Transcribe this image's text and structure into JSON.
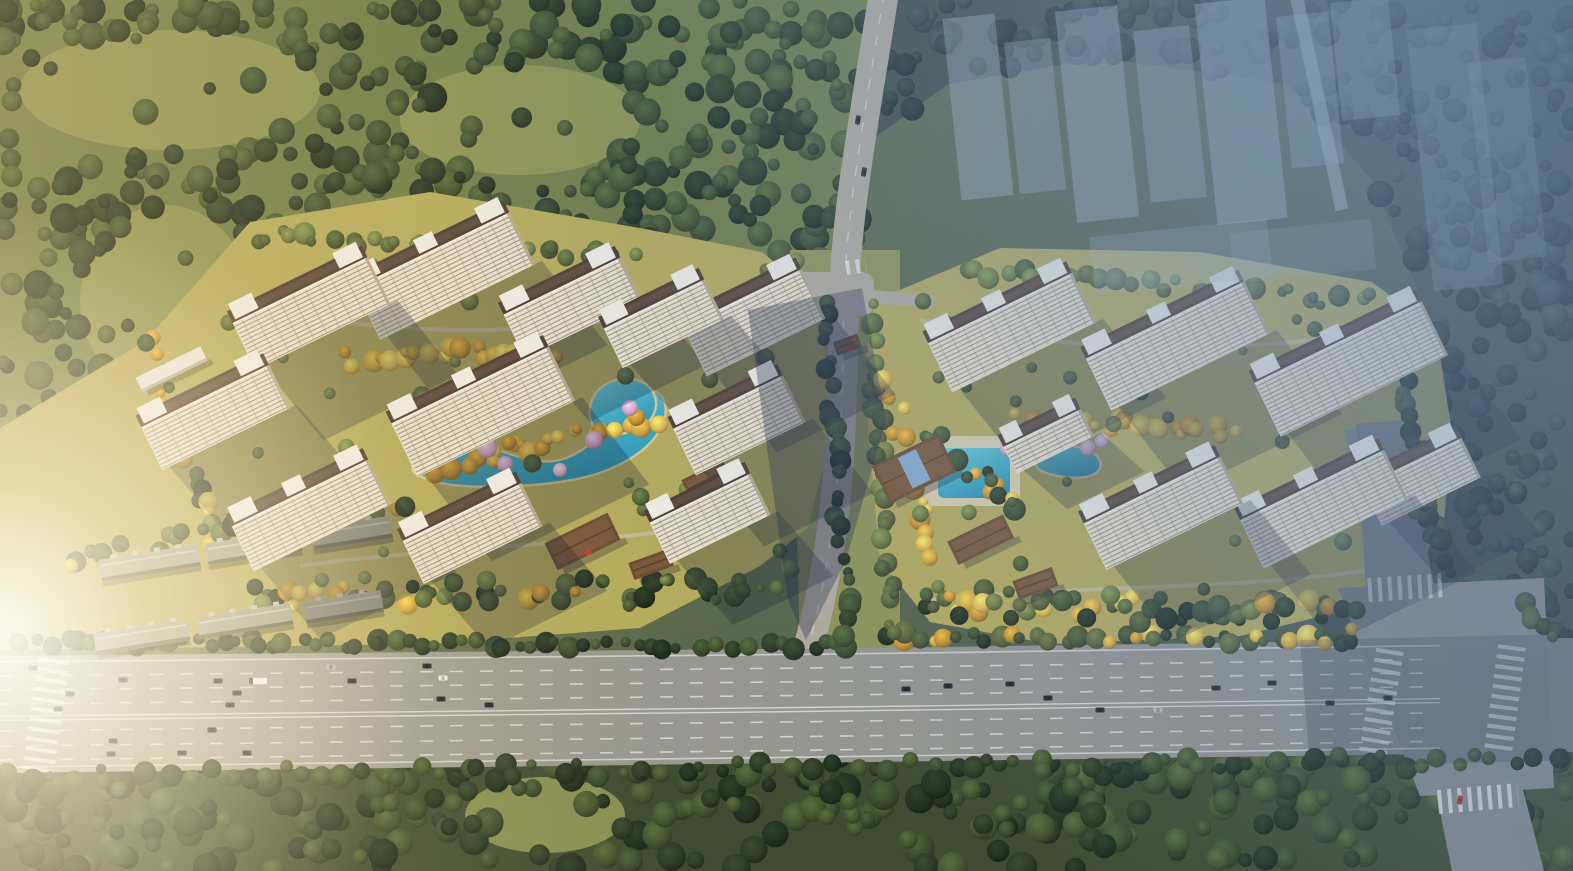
{
  "meta": {
    "type": "aerial-architectural-rendering",
    "width": 1573,
    "height": 871,
    "seed": 7
  },
  "palette": {
    "baseLeft": "#76824c",
    "baseRight": "#47564b",
    "meadow": "#8f9755",
    "forestBaseA": "#6f7d48",
    "forestBaseB": "#3f4c31",
    "forestBaseC": "#3d4a41",
    "darkTrees": [
      "#2c3a25",
      "#3a4a2d",
      "#223020",
      "#43532f"
    ],
    "hazeTrees": [
      "#26332c",
      "#31403a",
      "#1e2a26"
    ],
    "goldTrees": [
      "#d2a33c",
      "#e2b94e",
      "#c08f2f"
    ],
    "siteTrees": [
      "#556237",
      "#6a783f",
      "#485531"
    ],
    "siteLawn": "#b5ab5c",
    "corridorGround": "#8f9457",
    "westLawn": "#b8a95e",
    "water": "#41b8c6",
    "waterLight": "#6fd2da",
    "waterDeep": "#2795b4",
    "waterEdge": "#d8c892",
    "poolDeck": "#d9cfae",
    "blossoms": [
      "#eebbd4",
      "#d9a3c4",
      "#e4afc9"
    ],
    "facade": "#e9e1cd",
    "floorLine": "#57493c",
    "mullion": "#8b7d6a",
    "roof": "#4c3c31",
    "roofInner": "#6b564a",
    "roofBox": "#efece3",
    "endCap": "#b4a88f",
    "towerShadow": "rgba(19,29,46,0.28)",
    "lowRoof": "#a4a38c",
    "lowRidge": "#c6c5b0",
    "lowEdge": "#5f614b",
    "podium": "#e8e6dc",
    "club": "#6b4d33",
    "clubRidge": "#84603f",
    "skylight": "#86add0",
    "redAccent": "#c23b2e",
    "asphalt": "#97978f",
    "asphaltLight": "#b2ab9e",
    "asphaltDark": "#85888b",
    "roadLine": "rgba(255,255,255,0.75)",
    "sidewalk": "#cfc7b3",
    "carDark": "#262b33",
    "carWhite": "#f1f1ee",
    "carSilver": "#b7babc",
    "carRed": "#b03a30",
    "ghost": "#a9bccd",
    "stream": "#5e7487",
    "trail": "#8a9160",
    "bigShadow": "rgba(28,38,66,0.35)",
    "zoneShadow": "rgba(25,35,52,0.22)"
  },
  "scene": {
    "forests": [
      {
        "name": "forest-top-left",
        "base": "forestBaseA",
        "n": 400,
        "rmin": 6,
        "rmax": 15,
        "mix": "dark",
        "poly": [
          [
            0,
            0
          ],
          [
            878,
            0
          ],
          [
            852,
            292
          ],
          [
            742,
            302
          ],
          [
            642,
            252
          ],
          [
            470,
            206
          ],
          [
            300,
            212
          ],
          [
            150,
            340
          ],
          [
            0,
            432
          ]
        ],
        "meadows": [
          {
            "cx": 170,
            "cy": 90,
            "rx": 150,
            "ry": 60
          },
          {
            "cx": 165,
            "cy": 300,
            "rx": 85,
            "ry": 95
          },
          {
            "cx": 520,
            "cy": 120,
            "rx": 120,
            "ry": 55
          }
        ]
      },
      {
        "name": "forest-bottom",
        "base": "forestBaseB",
        "n": 310,
        "rmin": 7,
        "rmax": 16,
        "mix": "dark",
        "poly": [
          [
            0,
            758
          ],
          [
            1573,
            746
          ],
          [
            1573,
            871
          ],
          [
            0,
            871
          ]
        ],
        "meadows": [
          {
            "cx": 545,
            "cy": 815,
            "rx": 80,
            "ry": 38
          }
        ]
      },
      {
        "name": "forest-right-haze",
        "base": "forestBaseC",
        "n": 290,
        "rmin": 6,
        "rmax": 14,
        "mix": "haze",
        "poly": [
          [
            880,
            0
          ],
          [
            1573,
            0
          ],
          [
            1573,
            752
          ],
          [
            1500,
            748
          ],
          [
            1468,
            640
          ],
          [
            1442,
            540
          ],
          [
            1430,
            320
          ],
          [
            1372,
            180
          ],
          [
            1288,
            84
          ],
          [
            1100,
            58
          ],
          [
            948,
            84
          ],
          [
            872,
            140
          ]
        ],
        "meadows": []
      }
    ],
    "westLawnPoly": [
      [
        0,
        428
      ],
      [
        150,
        338
      ],
      [
        280,
        380
      ],
      [
        420,
        470
      ],
      [
        430,
        644
      ],
      [
        0,
        650
      ]
    ],
    "corridorPoly": [
      [
        790,
        250
      ],
      [
        900,
        250
      ],
      [
        900,
        655
      ],
      [
        800,
        655
      ]
    ],
    "sites": [
      {
        "name": "site-left-lawn",
        "poly": [
          [
            150,
            336
          ],
          [
            250,
            222
          ],
          [
            430,
            192
          ],
          [
            640,
            228
          ],
          [
            762,
            252
          ],
          [
            820,
            300
          ],
          [
            832,
            430
          ],
          [
            808,
            528
          ],
          [
            760,
            566
          ],
          [
            640,
            628
          ],
          [
            430,
            644
          ],
          [
            300,
            622
          ],
          [
            210,
            562
          ],
          [
            160,
            452
          ]
        ]
      },
      {
        "name": "site-right-lawn",
        "poly": [
          [
            876,
            300
          ],
          [
            1000,
            248
          ],
          [
            1200,
            252
          ],
          [
            1372,
            282
          ],
          [
            1436,
            330
          ],
          [
            1452,
            432
          ],
          [
            1442,
            544
          ],
          [
            1380,
            602
          ],
          [
            1240,
            636
          ],
          [
            1050,
            644
          ],
          [
            930,
            622
          ],
          [
            880,
            560
          ],
          [
            868,
            430
          ],
          [
            868,
            330
          ]
        ]
      }
    ],
    "walkways": [
      "M258,306 C380,336 540,340 690,306",
      "M300,566 C440,546 600,546 724,522",
      "M920,320 C1060,352 1240,356 1380,330",
      "M930,600 C1060,586 1240,590 1370,570"
    ],
    "stream": {
      "d": "M470,-6 C480,60 492,120 512,180 C530,232 560,280 592,318",
      "w": 13
    },
    "trail": {
      "d": "M-6,128 C140,96 300,62 436,-6",
      "w": 9
    },
    "ponds": [
      {
        "name": "pond-left-main",
        "d": "M414,462 C430,442 466,438 498,450 C524,459 546,466 566,458 C592,448 604,430 616,410 C626,392 642,384 656,392 C670,400 668,420 656,436 C640,458 606,474 572,480 C534,487 466,490 436,482 C418,477 408,472 414,462 Z"
      },
      {
        "name": "pond-left-lagoon",
        "d": "M594,428 C584,410 592,390 610,382 C628,374 648,380 654,394 C660,408 652,424 636,430 C622,435 602,438 594,428 Z"
      },
      {
        "name": "pond-right",
        "d": "M1036,462 C1040,448 1056,442 1074,446 C1092,450 1104,458 1100,468 C1096,478 1076,480 1058,476 C1044,473 1034,470 1036,462 Z"
      }
    ],
    "pool": {
      "deck": {
        "x": 924,
        "y": 436,
        "w": 96,
        "h": 70
      },
      "basin": {
        "x": 938,
        "y": 448,
        "w": 72,
        "h": 50
      }
    },
    "towersLeft": [
      [
        300,
        290,
        150,
        52,
        -26
      ],
      [
        432,
        250,
        172,
        58,
        -26
      ],
      [
        562,
        286,
        130,
        48,
        -26
      ],
      [
        654,
        304,
        112,
        44,
        -26
      ],
      [
        742,
        298,
        132,
        55,
        -26
      ],
      [
        205,
        396,
        142,
        48,
        -26
      ],
      [
        470,
        385,
        175,
        60,
        -26
      ],
      [
        728,
        402,
        122,
        52,
        -26
      ],
      [
        300,
        493,
        152,
        50,
        -26
      ],
      [
        462,
        512,
        132,
        48,
        -26
      ],
      [
        700,
        498,
        112,
        46,
        -26
      ]
    ],
    "towersRight": [
      [
        1000,
        308,
        160,
        55,
        -26
      ],
      [
        1165,
        320,
        176,
        58,
        -26
      ],
      [
        1338,
        342,
        186,
        60,
        -26
      ],
      [
        1042,
        428,
        86,
        30,
        -26
      ],
      [
        1152,
        490,
        152,
        52,
        -26
      ],
      [
        1312,
        485,
        160,
        54,
        -26
      ],
      [
        1412,
        462,
        110,
        44,
        -26
      ]
    ],
    "lowrises": [
      [
        148,
        552,
        100,
        -9
      ],
      [
        252,
        536,
        95,
        -9
      ],
      [
        350,
        522,
        80,
        -9
      ],
      [
        140,
        626,
        95,
        -9
      ],
      [
        243,
        610,
        95,
        -9
      ],
      [
        342,
        596,
        78,
        -9
      ]
    ],
    "podiums": [
      [
        168,
        362,
        72,
        16,
        -26
      ],
      [
        240,
        386,
        58,
        14,
        -26
      ]
    ],
    "clubs": [
      [
        576,
        528,
        70,
        30,
        -26,
        0,
        1
      ],
      [
        702,
        470,
        46,
        22,
        -26,
        0,
        0
      ],
      [
        648,
        556,
        42,
        18,
        -20,
        0,
        0
      ],
      [
        905,
        450,
        74,
        42,
        -26,
        1,
        0
      ],
      [
        975,
        528,
        62,
        26,
        -26,
        0,
        0
      ],
      [
        1032,
        574,
        42,
        20,
        -20,
        0,
        0
      ],
      [
        845,
        338,
        26,
        14,
        -20,
        0,
        1
      ]
    ],
    "treeStrips": [
      [
        6,
        642,
        856,
        646,
        10,
        64,
        "dark"
      ],
      [
        884,
        636,
        1356,
        640,
        10,
        40,
        "mixed"
      ],
      [
        4,
        776,
        1570,
        760,
        14,
        80,
        "dark"
      ],
      [
        250,
        600,
        760,
        586,
        26,
        46,
        "mixed"
      ],
      [
        150,
        340,
        210,
        540,
        18,
        22,
        "mixed"
      ],
      [
        250,
        235,
        640,
        255,
        14,
        30,
        "site"
      ],
      [
        420,
        470,
        660,
        420,
        18,
        26,
        "gold"
      ],
      [
        340,
        360,
        560,
        350,
        16,
        20,
        "gold"
      ],
      [
        826,
        300,
        848,
        640,
        12,
        26,
        "dark"
      ],
      [
        872,
        300,
        892,
        640,
        12,
        26,
        "site"
      ],
      [
        900,
        600,
        1360,
        615,
        30,
        60,
        "mixed"
      ],
      [
        890,
        380,
        930,
        560,
        16,
        18,
        "gold"
      ],
      [
        1020,
        420,
        1240,
        430,
        16,
        22,
        "gold"
      ],
      [
        960,
        270,
        1380,
        300,
        14,
        30,
        "site"
      ],
      [
        1400,
        360,
        1440,
        560,
        14,
        18,
        "dark"
      ],
      [
        928,
        432,
        1012,
        508,
        18,
        14,
        "mixed"
      ],
      [
        1520,
        600,
        1560,
        640,
        12,
        8,
        "dark"
      ],
      [
        1410,
        480,
        1450,
        570,
        14,
        10,
        "dark"
      ],
      [
        60,
        560,
        420,
        500,
        20,
        26,
        "mixed"
      ]
    ],
    "siteScatter": [
      [
        180,
        240,
        620,
        380,
        45,
        "site"
      ],
      [
        900,
        280,
        520,
        330,
        40,
        "site"
      ]
    ],
    "blossoms": [
      [
        445,
        432,
        9
      ],
      [
        487,
        448,
        10
      ],
      [
        505,
        464,
        8
      ],
      [
        560,
        470,
        7
      ],
      [
        594,
        440,
        9
      ],
      [
        630,
        408,
        8
      ],
      [
        418,
        448,
        7
      ],
      [
        1008,
        448,
        8
      ],
      [
        1022,
        463,
        7
      ],
      [
        1088,
        448,
        8
      ],
      [
        1102,
        441,
        7
      ]
    ],
    "roads": {
      "highwayTop": [
        [
          0,
          656
        ],
        [
          870,
          648
        ],
        [
          1360,
          641
        ],
        [
          1573,
          638
        ]
      ],
      "highwayBottom": [
        [
          0,
          773
        ],
        [
          870,
          762
        ],
        [
          1573,
          752
        ]
      ],
      "laneDashesT": [
        0.17,
        0.29,
        0.41,
        0.64,
        0.77,
        0.89
      ],
      "centerLinesT": [
        0.515,
        0.55
      ],
      "edgeLinesT": [
        0.05,
        0.95
      ],
      "middle": {
        "d": "M884,-8 C866,110 846,210 844,300 C842,395 842,470 828,556 C820,606 812,632 806,658",
        "w": 30
      },
      "branchEast": {
        "d": "M790,291 C820,292 880,297 934,302",
        "w": 13
      },
      "plaza": {
        "x": 788,
        "y": 272,
        "w": 86,
        "h": 44
      },
      "northStub": [
        [
          1356,
          424
        ],
        [
          1402,
          420
        ],
        [
          1434,
          586
        ],
        [
          1366,
          592
        ]
      ],
      "iBox": [
        [
          1338,
          588
        ],
        [
          1544,
          578
        ],
        [
          1554,
          788
        ],
        [
          1420,
          796
        ]
      ],
      "southStub": [
        [
          1436,
          792
        ],
        [
          1522,
          786
        ],
        [
          1544,
          871
        ],
        [
          1452,
          871
        ]
      ],
      "eastRoad": {
        "d": "M1352,428 L1398,600",
        "w": 18
      },
      "faintTop": {
        "d": "M1296,-6 L1342,210",
        "w": 13
      }
    },
    "crosswalks": [
      [
        54,
        659,
        38,
        771,
        32
      ],
      [
        1390,
        650,
        1372,
        758,
        28
      ],
      [
        1512,
        646,
        1498,
        752,
        28
      ],
      [
        1368,
        590,
        1446,
        585,
        24
      ],
      [
        1438,
        802,
        1518,
        795,
        24
      ],
      [
        846,
        268,
        866,
        265,
        14
      ]
    ],
    "cars": [
      [
        33,
        668,
        0,
        0
      ],
      [
        70,
        694,
        0,
        0
      ],
      [
        58,
        709,
        0,
        0
      ],
      [
        123,
        680,
        0,
        0
      ],
      [
        113,
        741,
        0,
        0
      ],
      [
        111,
        754,
        0,
        0
      ],
      [
        182,
        753,
        0,
        0
      ],
      [
        218,
        681,
        0,
        0
      ],
      [
        237,
        693,
        0,
        0
      ],
      [
        230,
        705,
        0,
        0
      ],
      [
        247,
        753,
        0,
        0
      ],
      [
        258,
        681,
        4,
        0
      ],
      [
        331,
        667,
        2,
        0
      ],
      [
        352,
        681,
        0,
        0
      ],
      [
        427,
        666,
        0,
        0
      ],
      [
        443,
        678,
        1,
        0
      ],
      [
        441,
        699,
        0,
        0
      ],
      [
        489,
        705,
        0,
        0
      ],
      [
        212,
        730,
        0,
        0
      ],
      [
        906,
        689,
        0,
        0
      ],
      [
        948,
        686,
        0,
        0
      ],
      [
        1010,
        684,
        0,
        0
      ],
      [
        1048,
        698,
        0,
        0
      ],
      [
        1100,
        710,
        0,
        0
      ],
      [
        1158,
        710,
        2,
        0
      ],
      [
        1216,
        688,
        0,
        0
      ],
      [
        1272,
        683,
        0,
        0
      ],
      [
        1330,
        703,
        0,
        0
      ],
      [
        1388,
        698,
        0,
        0
      ],
      [
        858,
        120,
        0,
        1
      ],
      [
        864,
        172,
        0,
        1
      ],
      [
        1460,
        800,
        3,
        1
      ]
    ],
    "ghosts": [
      [
        952,
        16,
        52,
        182,
        0.4
      ],
      [
        1012,
        40,
        46,
        152,
        0.34
      ],
      [
        1066,
        8,
        62,
        212,
        0.42
      ],
      [
        1142,
        28,
        56,
        172,
        0.36
      ],
      [
        1206,
        0,
        70,
        222,
        0.45
      ],
      [
        1284,
        14,
        52,
        152,
        0.34
      ],
      [
        1336,
        0,
        58,
        118,
        0.3
      ],
      [
        1092,
        228,
        178,
        58,
        0.25
      ],
      [
        1232,
        226,
        142,
        50,
        0.22
      ],
      [
        1420,
        26,
        70,
        262,
        0.24
      ],
      [
        1478,
        60,
        58,
        200,
        0.2
      ]
    ],
    "shadowPolys": [
      [
        [
          748,
          310
        ],
        [
          862,
          288
        ],
        [
          886,
          420
        ],
        [
          846,
          560
        ],
        [
          806,
          640
        ],
        [
          788,
          600
        ],
        [
          770,
          470
        ]
      ],
      [
        [
          1300,
          640
        ],
        [
          1573,
          634
        ],
        [
          1573,
          760
        ],
        [
          1310,
          768
        ]
      ]
    ]
  }
}
